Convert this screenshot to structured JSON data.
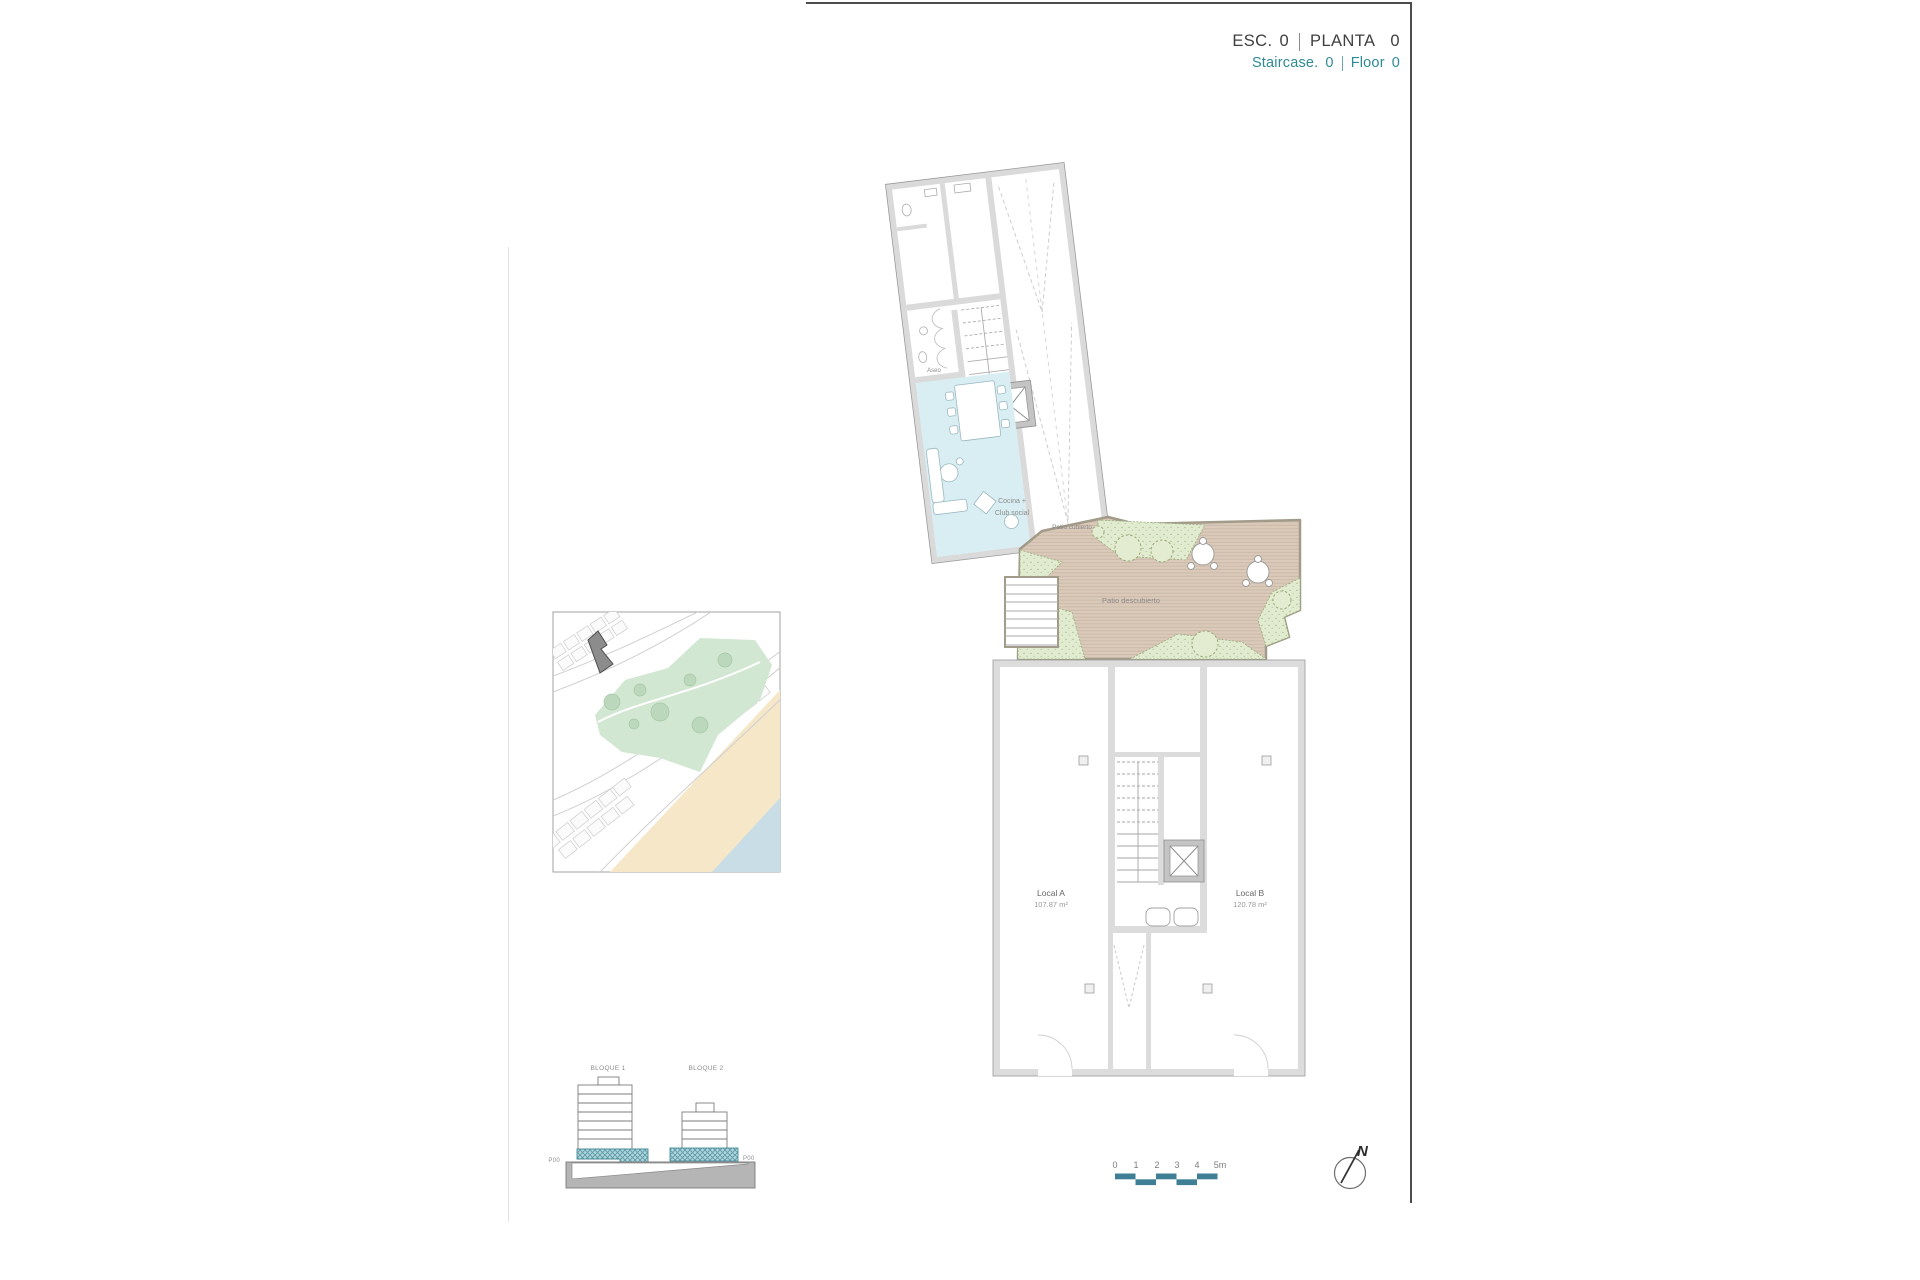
{
  "header": {
    "esc_label": "ESC.",
    "esc_value": "0",
    "planta_label": "PLANTA",
    "planta_value": "0",
    "staircase_label": "Staircase.",
    "staircase_value": "0",
    "floor_label": "Floor",
    "floor_value": "0"
  },
  "floor_plan": {
    "aseo_label": "Aseo",
    "cocina_label_line1": "Cocina +",
    "cocina_label_line2": "Club social",
    "patio_cubierto_label": "Patio cubierto",
    "patio_descubierto_label": "Patio descubierto",
    "local_a": {
      "name": "Local A",
      "area": "107.87 m²"
    },
    "local_b": {
      "name": "Local B",
      "area": "120.78 m²"
    }
  },
  "section_diagram": {
    "block1_label": "BLOQUE 1",
    "block2_label": "BLOQUE 2",
    "level_left": "P00",
    "level_right": "P00"
  },
  "scale_bar": {
    "ticks": [
      "0",
      "1",
      "2",
      "3",
      "4",
      "5m"
    ]
  },
  "compass": {
    "north_label": "N"
  },
  "colors": {
    "accent_teal": "#2E8B96",
    "scale_bar_teal": "#3E7F96",
    "section_highlight": "#AED7DE",
    "room_blue": "#D8EEF3",
    "patio_deck_tan": "#DBCABA",
    "landscape_green": "#E1EBCF",
    "map_green": "#D2E7D2",
    "beach_sand": "#F5E7C8",
    "sea_blue": "#C8DDE6",
    "highlight_building_gray": "#8C8C8C",
    "text_dark": "#3F3F3F",
    "text_gray": "#8B8B8B"
  }
}
